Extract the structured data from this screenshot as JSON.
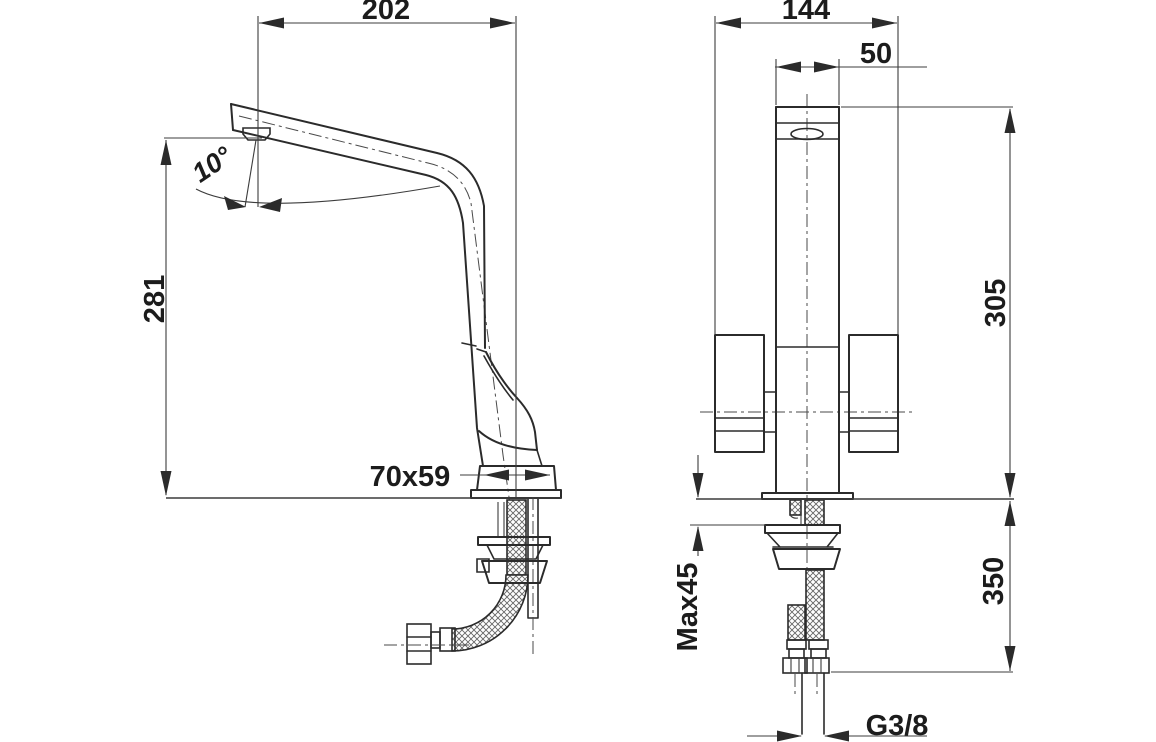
{
  "drawing": {
    "subject": "Kitchen sink mixer tap — dimensioned installation drawing, side view and front view",
    "units": "mm",
    "side_view": {
      "spout_reach": "202",
      "spout_angle": "10°",
      "spout_height": "281",
      "base_footprint": "70x59"
    },
    "front_view": {
      "overall_width": "144",
      "body_width": "50",
      "height_above_deck": "305",
      "max_deck_thickness": "Max45",
      "length_below_deck": "350",
      "connection_thread": "G3/8"
    },
    "colors": {
      "line": "#2b2b2b",
      "background": "#ffffff"
    }
  }
}
